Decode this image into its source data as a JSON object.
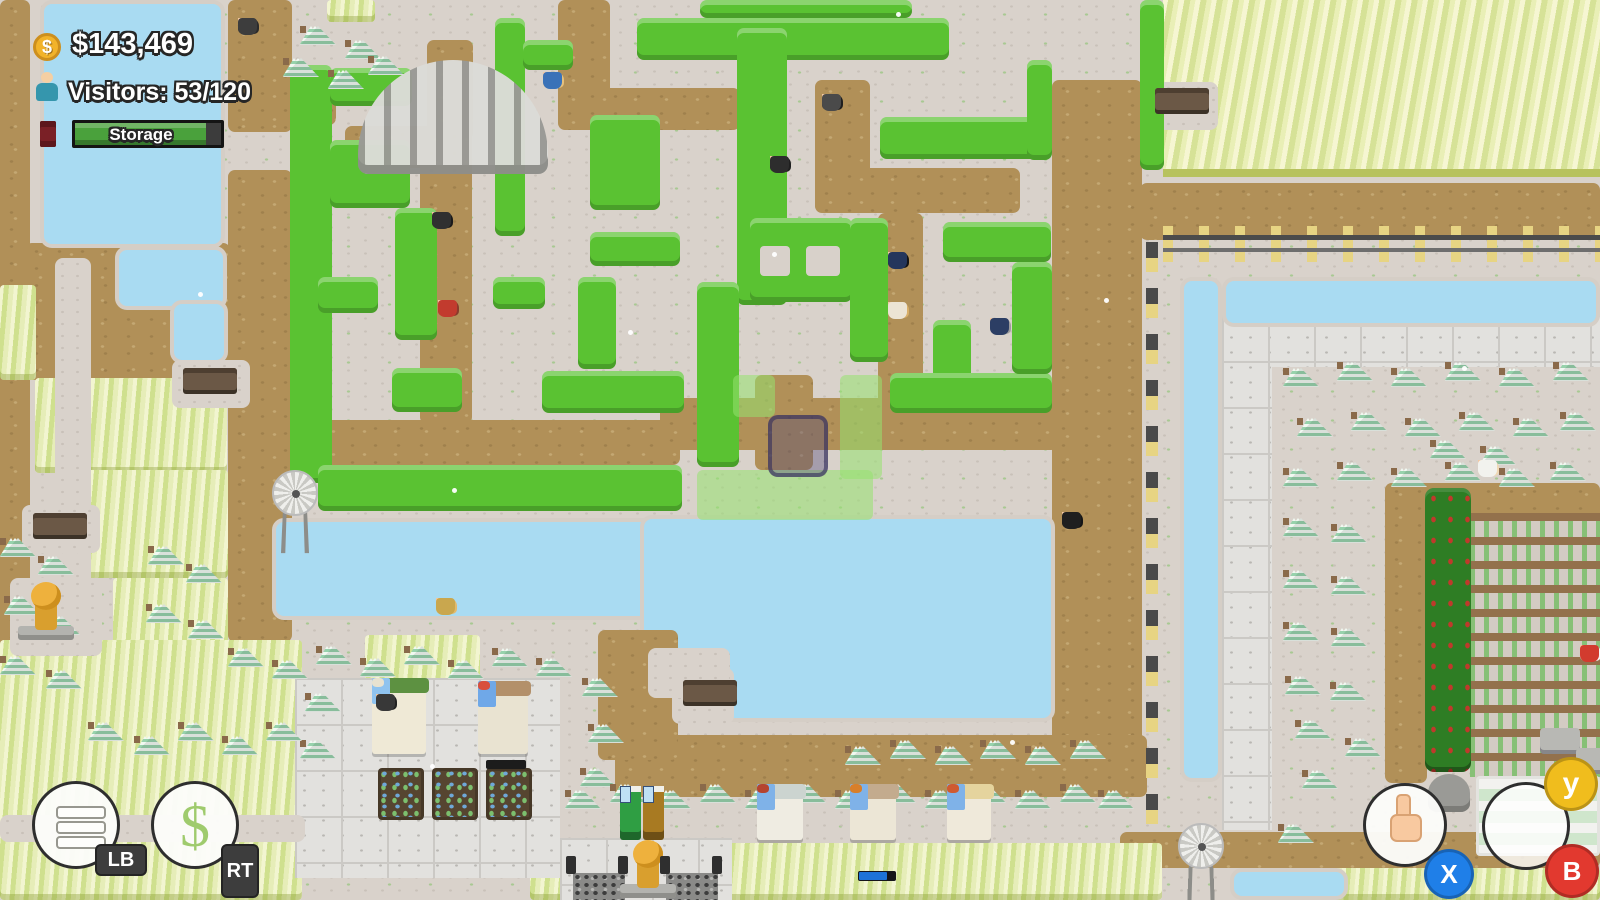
{
  "hud": {
    "money": "$143,469",
    "coin_symbol": "$",
    "visitors": "Visitors: 53/120",
    "storage_label": "Storage",
    "storage_fill_pct": 90
  },
  "controller": {
    "lb": "LB",
    "rt": "RT",
    "x": "X",
    "y": "y",
    "b": "B",
    "dollar_symbol": "$"
  },
  "colors": {
    "hedge_green": "#5ac232",
    "water_blue": "#a9dbf2",
    "dirt_brown": "#b19058",
    "gravel": "#d9d2cb",
    "storage_green": "#4aa13c",
    "coin_gold": "#f2b32a",
    "badge_x_blue": "#1f7fe8",
    "badge_y_yellow": "#f0bd1d",
    "badge_b_red": "#e2392f"
  },
  "scene": {
    "layers": [
      {
        "type": "dirt",
        "rects": [
          [
            0,
            0,
            30,
            650
          ],
          [
            25,
            243,
            205,
            137
          ],
          [
            228,
            0,
            64,
            132
          ],
          [
            228,
            85,
            108,
            40
          ],
          [
            228,
            170,
            64,
            472
          ],
          [
            345,
            126,
            126,
            42
          ],
          [
            427,
            40,
            46,
            100
          ],
          [
            420,
            128,
            52,
            296
          ],
          [
            318,
            420,
            362,
            45
          ],
          [
            558,
            0,
            52,
            112
          ],
          [
            558,
            88,
            182,
            42
          ],
          [
            815,
            80,
            55,
            132
          ],
          [
            815,
            168,
            205,
            45
          ],
          [
            878,
            213,
            45,
            205
          ],
          [
            660,
            398,
            398,
            52
          ],
          [
            755,
            375,
            58,
            95
          ],
          [
            1052,
            80,
            90,
            662
          ],
          [
            1140,
            183,
            460,
            57
          ],
          [
            615,
            735,
            532,
            62
          ],
          [
            1120,
            832,
            480,
            36
          ],
          [
            1385,
            483,
            42,
            300
          ],
          [
            1385,
            483,
            215,
            42
          ]
        ]
      },
      {
        "type": "grass",
        "rects": [
          [
            327,
            0,
            48,
            22
          ],
          [
            0,
            285,
            36,
            95
          ],
          [
            35,
            378,
            192,
            95
          ],
          [
            76,
            470,
            152,
            108
          ],
          [
            113,
            578,
            115,
            72
          ],
          [
            365,
            635,
            115,
            65
          ],
          [
            0,
            640,
            302,
            260
          ],
          [
            530,
            843,
            632,
            57
          ],
          [
            1300,
            868,
            300,
            32
          ]
        ]
      },
      {
        "type": "wheat",
        "rects": [
          [
            1163,
            0,
            437,
            177
          ]
        ]
      },
      {
        "type": "stone",
        "rects": [
          [
            295,
            678,
            265,
            200
          ],
          [
            560,
            838,
            172,
            62
          ],
          [
            1222,
            315,
            378,
            52
          ],
          [
            1222,
            315,
            50,
            515
          ]
        ]
      },
      {
        "type": "cobble",
        "rects": [
          [
            573,
            873,
            52,
            27
          ],
          [
            666,
            873,
            52,
            27
          ]
        ]
      },
      {
        "type": "crops",
        "rects": [
          [
            1470,
            513,
            130,
            264
          ]
        ]
      },
      {
        "type": "water",
        "rects": [
          [
            40,
            0,
            185,
            248
          ],
          [
            115,
            246,
            112,
            64
          ],
          [
            170,
            300,
            58,
            64
          ],
          [
            272,
            518,
            420,
            102
          ],
          [
            640,
            515,
            415,
            207
          ],
          [
            1180,
            277,
            42,
            505
          ],
          [
            1222,
            277,
            378,
            50
          ],
          [
            1230,
            868,
            118,
            32
          ]
        ]
      },
      {
        "type": "dirt",
        "rects": [
          [
            598,
            630,
            80,
            130
          ]
        ]
      },
      {
        "type": "gravel",
        "rects": [
          [
            672,
            668,
            62,
            56
          ],
          [
            55,
            258,
            36,
            384
          ],
          [
            0,
            815,
            305,
            27
          ],
          [
            172,
            360,
            78,
            48
          ],
          [
            22,
            505,
            78,
            48
          ],
          [
            648,
            648,
            82,
            50
          ],
          [
            1146,
            82,
            72,
            48
          ],
          [
            10,
            578,
            92,
            78
          ]
        ]
      },
      {
        "type": "hedge",
        "rects": [
          [
            290,
            65,
            42,
            418
          ],
          [
            330,
            68,
            82,
            38
          ],
          [
            330,
            140,
            80,
            68
          ],
          [
            395,
            208,
            42,
            132
          ],
          [
            318,
            277,
            60,
            36
          ],
          [
            493,
            277,
            52,
            32
          ],
          [
            578,
            277,
            38,
            92
          ],
          [
            392,
            368,
            70,
            44
          ],
          [
            542,
            371,
            142,
            42
          ],
          [
            318,
            465,
            364,
            46
          ],
          [
            637,
            18,
            312,
            42
          ],
          [
            700,
            0,
            212,
            18
          ],
          [
            737,
            28,
            50,
            277
          ],
          [
            590,
            115,
            70,
            95
          ],
          [
            590,
            232,
            90,
            34
          ],
          [
            880,
            117,
            162,
            42
          ],
          [
            1027,
            60,
            25,
            100
          ],
          [
            750,
            218,
            102,
            84
          ],
          [
            943,
            222,
            108,
            40
          ],
          [
            850,
            218,
            38,
            144
          ],
          [
            933,
            320,
            38,
            90
          ],
          [
            890,
            373,
            162,
            40
          ],
          [
            1012,
            262,
            40,
            112
          ],
          [
            697,
            282,
            42,
            185
          ],
          [
            1140,
            0,
            24,
            170
          ],
          [
            495,
            18,
            30,
            218
          ],
          [
            523,
            40,
            50,
            30
          ]
        ]
      },
      {
        "type": "hole",
        "rects": [
          [
            760,
            246,
            30,
            30
          ],
          [
            806,
            246,
            34,
            30
          ]
        ]
      },
      {
        "type": "darkhedge",
        "rects": [
          [
            1425,
            488,
            46,
            284
          ]
        ]
      },
      {
        "type": "ghost",
        "rects": [
          [
            733,
            375,
            42,
            42
          ],
          [
            840,
            375,
            42,
            104
          ],
          [
            697,
            470,
            176,
            50
          ]
        ]
      },
      {
        "type": "fenceh",
        "rects": [
          [
            1163,
            226,
            437,
            36
          ]
        ]
      },
      {
        "type": "fencev",
        "rects": [
          [
            1146,
            242,
            12,
            592
          ]
        ]
      }
    ],
    "trees": [
      [
        300,
        26
      ],
      [
        345,
        40
      ],
      [
        283,
        58
      ],
      [
        328,
        70
      ],
      [
        368,
        56
      ],
      [
        0,
        538
      ],
      [
        38,
        556
      ],
      [
        4,
        596
      ],
      [
        44,
        616
      ],
      [
        0,
        656
      ],
      [
        46,
        670
      ],
      [
        148,
        546
      ],
      [
        186,
        564
      ],
      [
        146,
        604
      ],
      [
        188,
        620
      ],
      [
        228,
        648
      ],
      [
        272,
        660
      ],
      [
        316,
        646
      ],
      [
        360,
        658
      ],
      [
        404,
        646
      ],
      [
        448,
        660
      ],
      [
        492,
        648
      ],
      [
        536,
        658
      ],
      [
        305,
        693
      ],
      [
        300,
        740
      ],
      [
        582,
        678
      ],
      [
        588,
        724
      ],
      [
        580,
        768
      ],
      [
        565,
        790
      ],
      [
        610,
        784
      ],
      [
        655,
        790
      ],
      [
        700,
        784
      ],
      [
        745,
        790
      ],
      [
        790,
        784
      ],
      [
        835,
        790
      ],
      [
        880,
        784
      ],
      [
        925,
        790
      ],
      [
        970,
        784
      ],
      [
        1015,
        790
      ],
      [
        1060,
        784
      ],
      [
        1098,
        790
      ],
      [
        845,
        746
      ],
      [
        890,
        740
      ],
      [
        935,
        746
      ],
      [
        980,
        740
      ],
      [
        1025,
        746
      ],
      [
        1070,
        740
      ],
      [
        88,
        722
      ],
      [
        134,
        736
      ],
      [
        178,
        722
      ],
      [
        222,
        736
      ],
      [
        266,
        722
      ],
      [
        1283,
        368
      ],
      [
        1337,
        362
      ],
      [
        1391,
        368
      ],
      [
        1445,
        362
      ],
      [
        1499,
        368
      ],
      [
        1553,
        362
      ],
      [
        1297,
        418
      ],
      [
        1351,
        412
      ],
      [
        1405,
        418
      ],
      [
        1459,
        412
      ],
      [
        1513,
        418
      ],
      [
        1560,
        412
      ],
      [
        1283,
        468
      ],
      [
        1337,
        462
      ],
      [
        1391,
        468
      ],
      [
        1445,
        462
      ],
      [
        1499,
        468
      ],
      [
        1550,
        462
      ],
      [
        1283,
        518
      ],
      [
        1331,
        524
      ],
      [
        1283,
        570
      ],
      [
        1331,
        576
      ],
      [
        1283,
        622
      ],
      [
        1331,
        628
      ],
      [
        1285,
        676
      ],
      [
        1330,
        682
      ],
      [
        1295,
        720
      ],
      [
        1345,
        738
      ],
      [
        1302,
        770
      ],
      [
        1278,
        824
      ],
      [
        1430,
        440
      ],
      [
        1480,
        446
      ]
    ],
    "people": [
      [
        238,
        18,
        "#2b2b2b",
        "#3d3d3d"
      ],
      [
        543,
        72,
        "#e6c17c",
        "#3a72b8"
      ],
      [
        822,
        94,
        "#1f1f1f",
        "#4a4a4a"
      ],
      [
        770,
        156,
        "#1f1f1f",
        "#2d2d2d"
      ],
      [
        888,
        252,
        "#141414",
        "#24365c"
      ],
      [
        888,
        302,
        "#d8ae68",
        "#ece4d4"
      ],
      [
        990,
        318,
        "#9c9c9c",
        "#2c3e64"
      ],
      [
        432,
        212,
        "#1a1a1a",
        "#303030"
      ],
      [
        438,
        300,
        "#8a3c2c",
        "#c23b2e"
      ],
      [
        1062,
        512,
        "#161616",
        "#1f1f1f"
      ],
      [
        436,
        598,
        "#e2ba6c",
        "#c9a74e"
      ],
      [
        376,
        694,
        "#222222",
        "#383838"
      ],
      [
        1478,
        460,
        "#efd8b4",
        "#f2f2ee"
      ],
      [
        1580,
        645,
        "#f5f5f5",
        "#d23b2e"
      ]
    ],
    "benches": [
      [
        183,
        368
      ],
      [
        33,
        513
      ],
      [
        683,
        680
      ],
      [
        1155,
        88
      ]
    ],
    "statues": [
      [
        18,
        582
      ],
      [
        620,
        840
      ]
    ],
    "windmills": [
      [
        272,
        470
      ],
      [
        1178,
        823
      ]
    ],
    "vendings": [
      [
        620,
        786,
        "#2f9e43"
      ],
      [
        643,
        786,
        "#a87a22"
      ]
    ],
    "shops": [
      {
        "x": 372,
        "y": 678,
        "w": 54,
        "h": 76,
        "awning": "#5d9141",
        "wall": "#efe9d6",
        "door": "#8fc3ef",
        "accent": "#e8e2d0"
      },
      {
        "x": 478,
        "y": 681,
        "w": 50,
        "h": 73,
        "awning": "#b3906a",
        "wall": "#e9e3d1",
        "door": "#6fa8e8",
        "accent": "#d94f3d"
      },
      {
        "x": 757,
        "y": 784,
        "w": 46,
        "h": 56,
        "awning": "#ccd4d0",
        "wall": "#efece2",
        "door": "#7fb2e8",
        "accent": "#b5432f"
      },
      {
        "x": 850,
        "y": 784,
        "w": 46,
        "h": 56,
        "awning": "#c3ab8e",
        "wall": "#ece6d6",
        "door": "#7fb2e8",
        "accent": "#d87f2a"
      },
      {
        "x": 947,
        "y": 784,
        "w": 44,
        "h": 56,
        "awning": "#e5d49e",
        "wall": "#efe9da",
        "door": "#7fb2e8",
        "accent": "#cf5a31"
      }
    ],
    "crop_plots": [
      [
        378,
        768
      ],
      [
        432,
        768
      ],
      [
        486,
        768
      ]
    ],
    "signs": [
      [
        486,
        760,
        40,
        9
      ]
    ],
    "posts": [
      [
        566,
        856
      ],
      [
        618,
        856
      ],
      [
        660,
        856
      ],
      [
        712,
        856
      ]
    ],
    "tables": [
      [
        1540,
        728
      ],
      [
        1576,
        748
      ]
    ],
    "mound": [
      1428,
      774,
      42,
      38
    ],
    "greenhouse": [
      1476,
      776,
      124,
      80
    ],
    "aviary": [
      358,
      60,
      190,
      114
    ],
    "progress_bar": {
      "x": 858,
      "y": 871,
      "w": 38,
      "h": 10,
      "fill_pct": 78
    },
    "cursor": [
      768,
      415,
      60,
      62
    ],
    "snow": [
      [
        198,
        292
      ],
      [
        772,
        252
      ],
      [
        1104,
        298
      ],
      [
        628,
        330
      ],
      [
        452,
        488
      ],
      [
        896,
        12
      ],
      [
        1462,
        366
      ],
      [
        430,
        764
      ],
      [
        1010,
        740
      ]
    ]
  }
}
